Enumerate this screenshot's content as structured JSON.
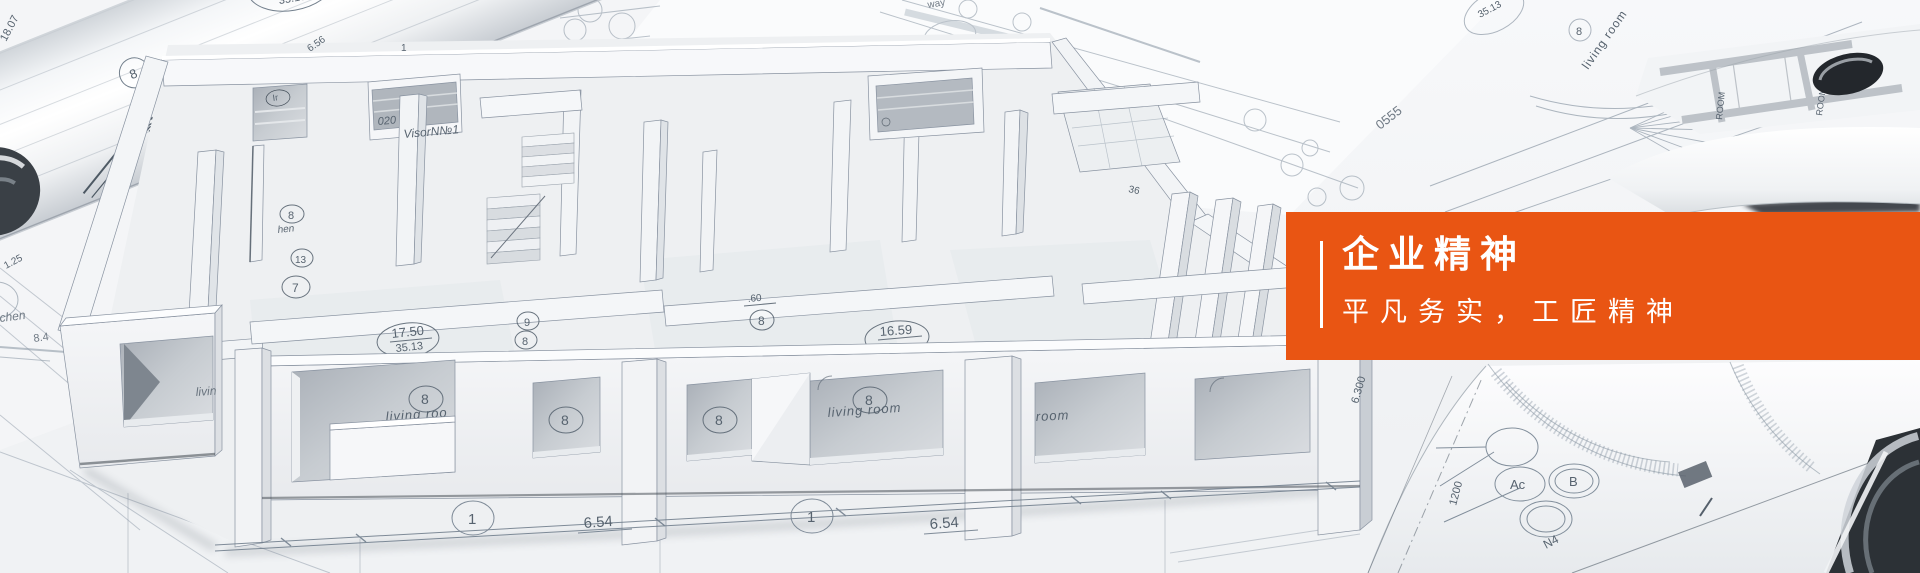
{
  "banner": {
    "title": "企业精神",
    "subtitle": "平凡务实，工匠精神",
    "accent_color": "#e95513",
    "text_color": "#ffffff"
  },
  "blueprint": {
    "living_room": "living room",
    "living_room_partial": "living roo",
    "living_partial": "livin",
    "room_partial": "room",
    "kitchen_partial": "chen",
    "kitchen_partial2": "hen",
    "visor_label": "VisorN№1",
    "num_020": "020",
    "area1_top": "17.50",
    "area1_bottom": "35.13",
    "area2_top": "16.59",
    "dim_654": "6.54",
    "dim_1807": "18.07",
    "dim_1750": "17.50",
    "dim_125": "1.25",
    "dim_84": "8.4",
    "dim_656": "6.56",
    "dim_36": "36",
    "dim_60": ".60",
    "dim_6300": "6.300",
    "num_0555": "0555",
    "dim_1200": "1200",
    "label_n4": "N4",
    "label_way": "way",
    "label_ir": "Ir",
    "room_stamp": "ROOM",
    "badge_1": "1",
    "badge_6": "6",
    "badge_7": "7",
    "badge_8": "8",
    "badge_9": "9",
    "badge_13": "13",
    "badge_ac": "Ac",
    "badge_b": "B"
  }
}
